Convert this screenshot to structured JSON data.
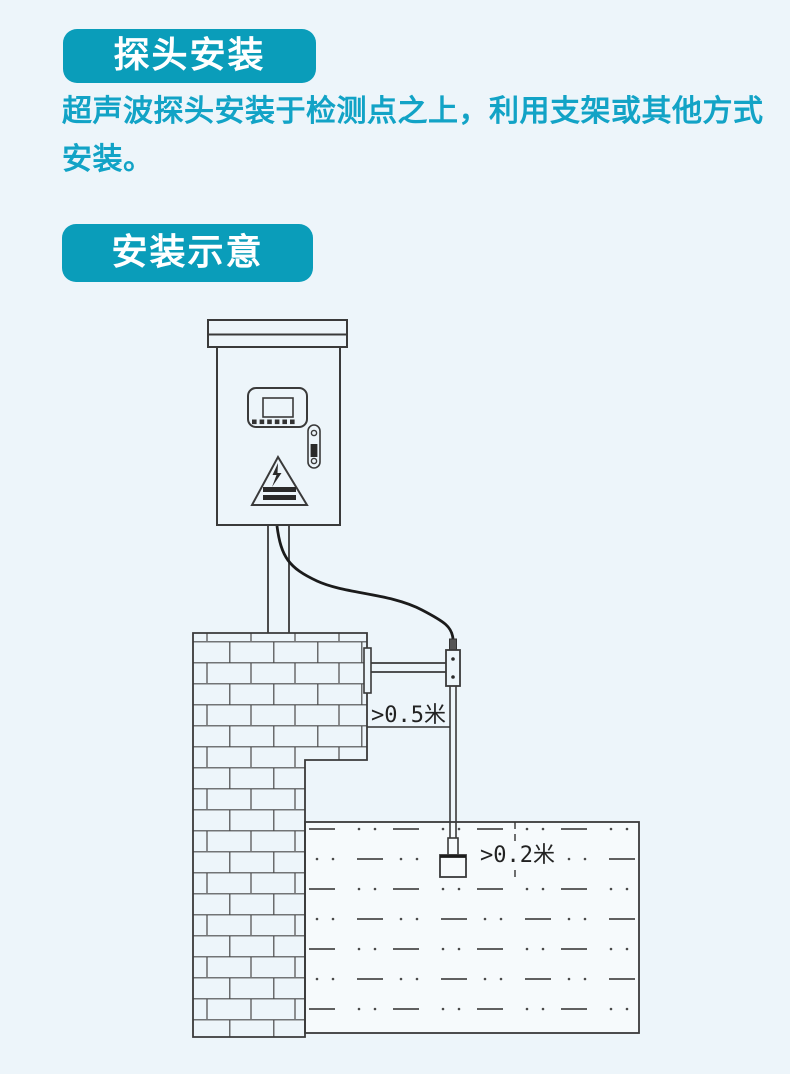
{
  "theme": {
    "page_bg": "#edf5fa",
    "badge_bg": "#0a9dba",
    "badge_text_color": "#ffffff",
    "paragraph_color": "#12a3c6",
    "diagram_line_color": "#3a3a3a",
    "water_fill": "#f6fafc"
  },
  "probe_install": {
    "badge_label": "探头安装",
    "description": "超声波探头安装于检测点之上，利用支架或其他方式安装。"
  },
  "install_diagram": {
    "badge_label": "安装示意",
    "dimension_wall_offset": ">0.5米",
    "dimension_water_clearance": ">0.2米",
    "icons": [
      "control-cabinet-icon",
      "display-panel-icon",
      "door-handle-icon",
      "high-voltage-warning-icon",
      "mounting-pole-icon",
      "signal-cable-icon",
      "brick-wall-icon",
      "probe-bracket-icon",
      "ultrasonic-probe-icon",
      "water-body-icon"
    ]
  }
}
